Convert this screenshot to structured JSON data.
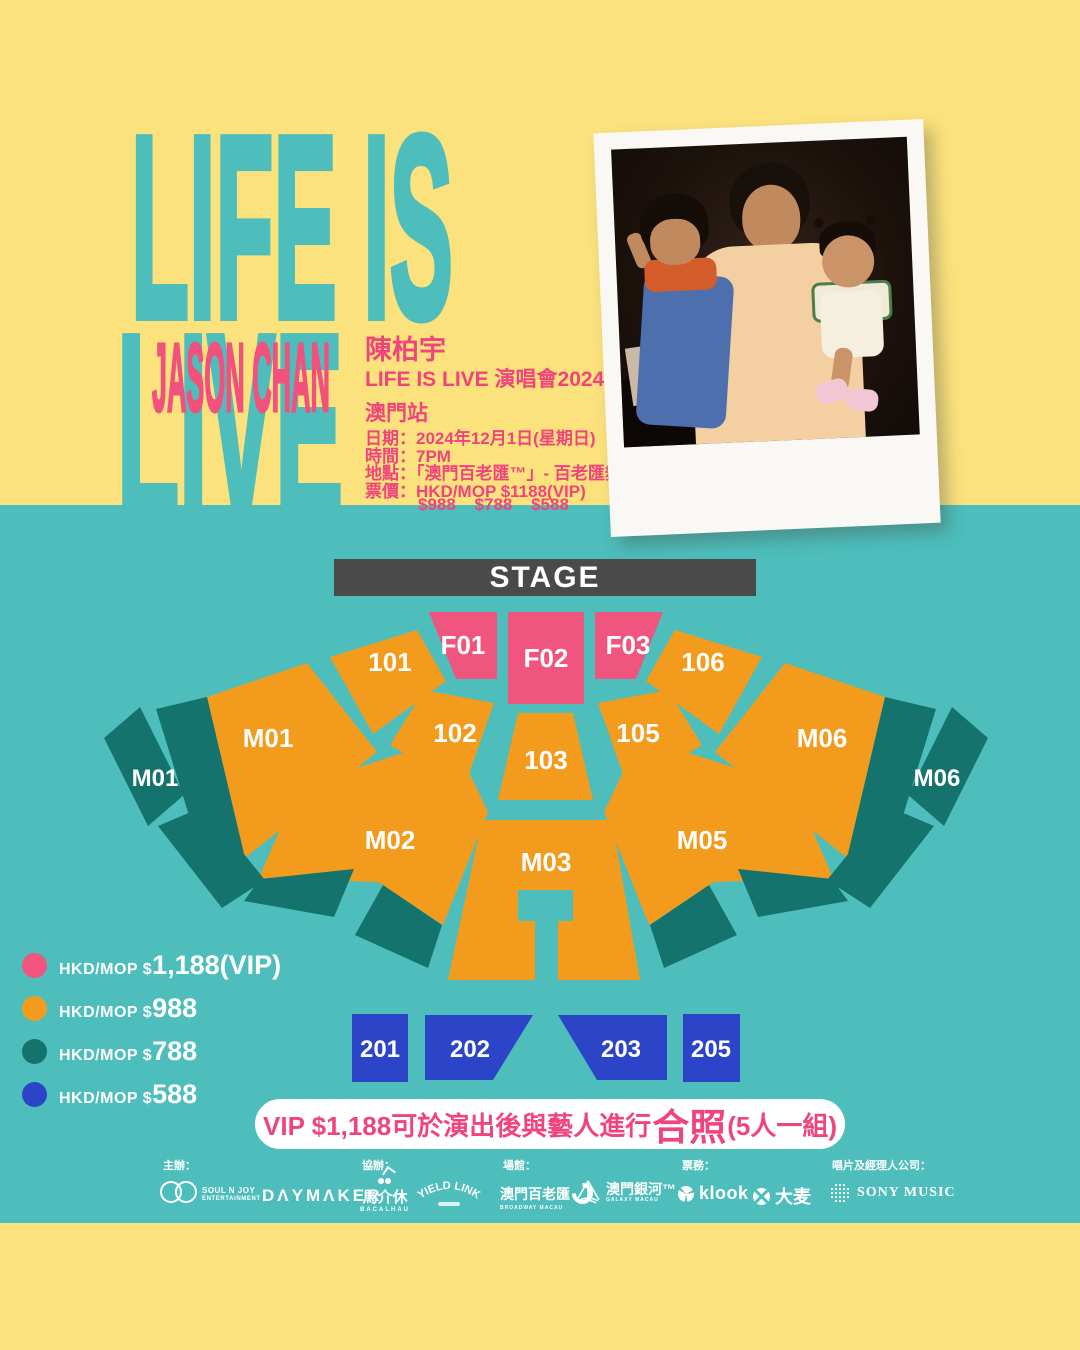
{
  "colors": {
    "yellow": "#FBE27D",
    "teal_background": "#4DBEBC",
    "dark_teal": "#15736D",
    "orange": "#F29B1D",
    "pink": "#F0557F",
    "blue": "#2B44C8",
    "stage_gray": "#4A4A4A",
    "accent_pink_text": "#F0457C",
    "white": "#FFFFFF"
  },
  "hero": {
    "title_line1": "LIFE IS",
    "title_line2": "LIVE",
    "artist_en": "JASON CHAN",
    "artist_zh": "陳柏宇",
    "event_line": "LIFE IS LIVE 演唱會2024",
    "city_line": "澳門站",
    "date_line": "日期：2024年12月1日(星期日)",
    "time_line": "時間：7PM",
    "venue_line": "地點：「澳門百老匯™」- 百老匯舞台",
    "price_line": "票價：HKD/MOP $1188(VIP)",
    "price_line2": "$988 $788 $588"
  },
  "seatmap": {
    "stage": "STAGE",
    "labels": {
      "f01": "F01",
      "f02": "F02",
      "f03": "F03",
      "r101": "101",
      "r102": "102",
      "r103": "103",
      "r105": "105",
      "r106": "106",
      "m01": "M01",
      "m02": "M02",
      "m03": "M03",
      "m05": "M05",
      "m06": "M06",
      "m01_side": "M01",
      "m06_side": "M06",
      "b201": "201",
      "b202": "202",
      "b203": "203",
      "b205": "205"
    }
  },
  "legend": {
    "items": [
      {
        "tier": "vip",
        "color": "#F0557F",
        "prefix": "HKD/MOP $",
        "value": "1,188(VIP)"
      },
      {
        "tier": "cat1",
        "color": "#F29B1D",
        "prefix": "HKD/MOP $",
        "value": "988"
      },
      {
        "tier": "cat2",
        "color": "#15736D",
        "prefix": "HKD/MOP $",
        "value": "788"
      },
      {
        "tier": "cat3",
        "color": "#2B44C8",
        "prefix": "HKD/MOP $",
        "value": "588"
      }
    ]
  },
  "vip_note": {
    "before": "VIP $1,188可於演出後與藝人進行",
    "highlight": "合照",
    "after": "(5人一組)"
  },
  "footer": {
    "organizer_label": "主辦：",
    "coorganizer_label": "協辦：",
    "venue_label": "場館：",
    "ticketing_label": "票務：",
    "record_label": "唱片及經理人公司：",
    "soulnjoy_line1": "SOUL N JOY",
    "soulnjoy_line2": "ENTERTAINMENT",
    "daymaker": "DΛYMΛKER",
    "bacalhau_zh": "馬介休",
    "bacalhau_en": "BACALHAU",
    "yieldlink": "YIELD LINK",
    "broadway_zh": "澳門百老匯",
    "broadway_en": "BROADWAY MACAU",
    "galaxy_zh": "澳門銀河™",
    "galaxy_en": "GALAXY MACAU",
    "klook": "klook",
    "damai": "大麦",
    "sony": "SONY MUSIC"
  }
}
